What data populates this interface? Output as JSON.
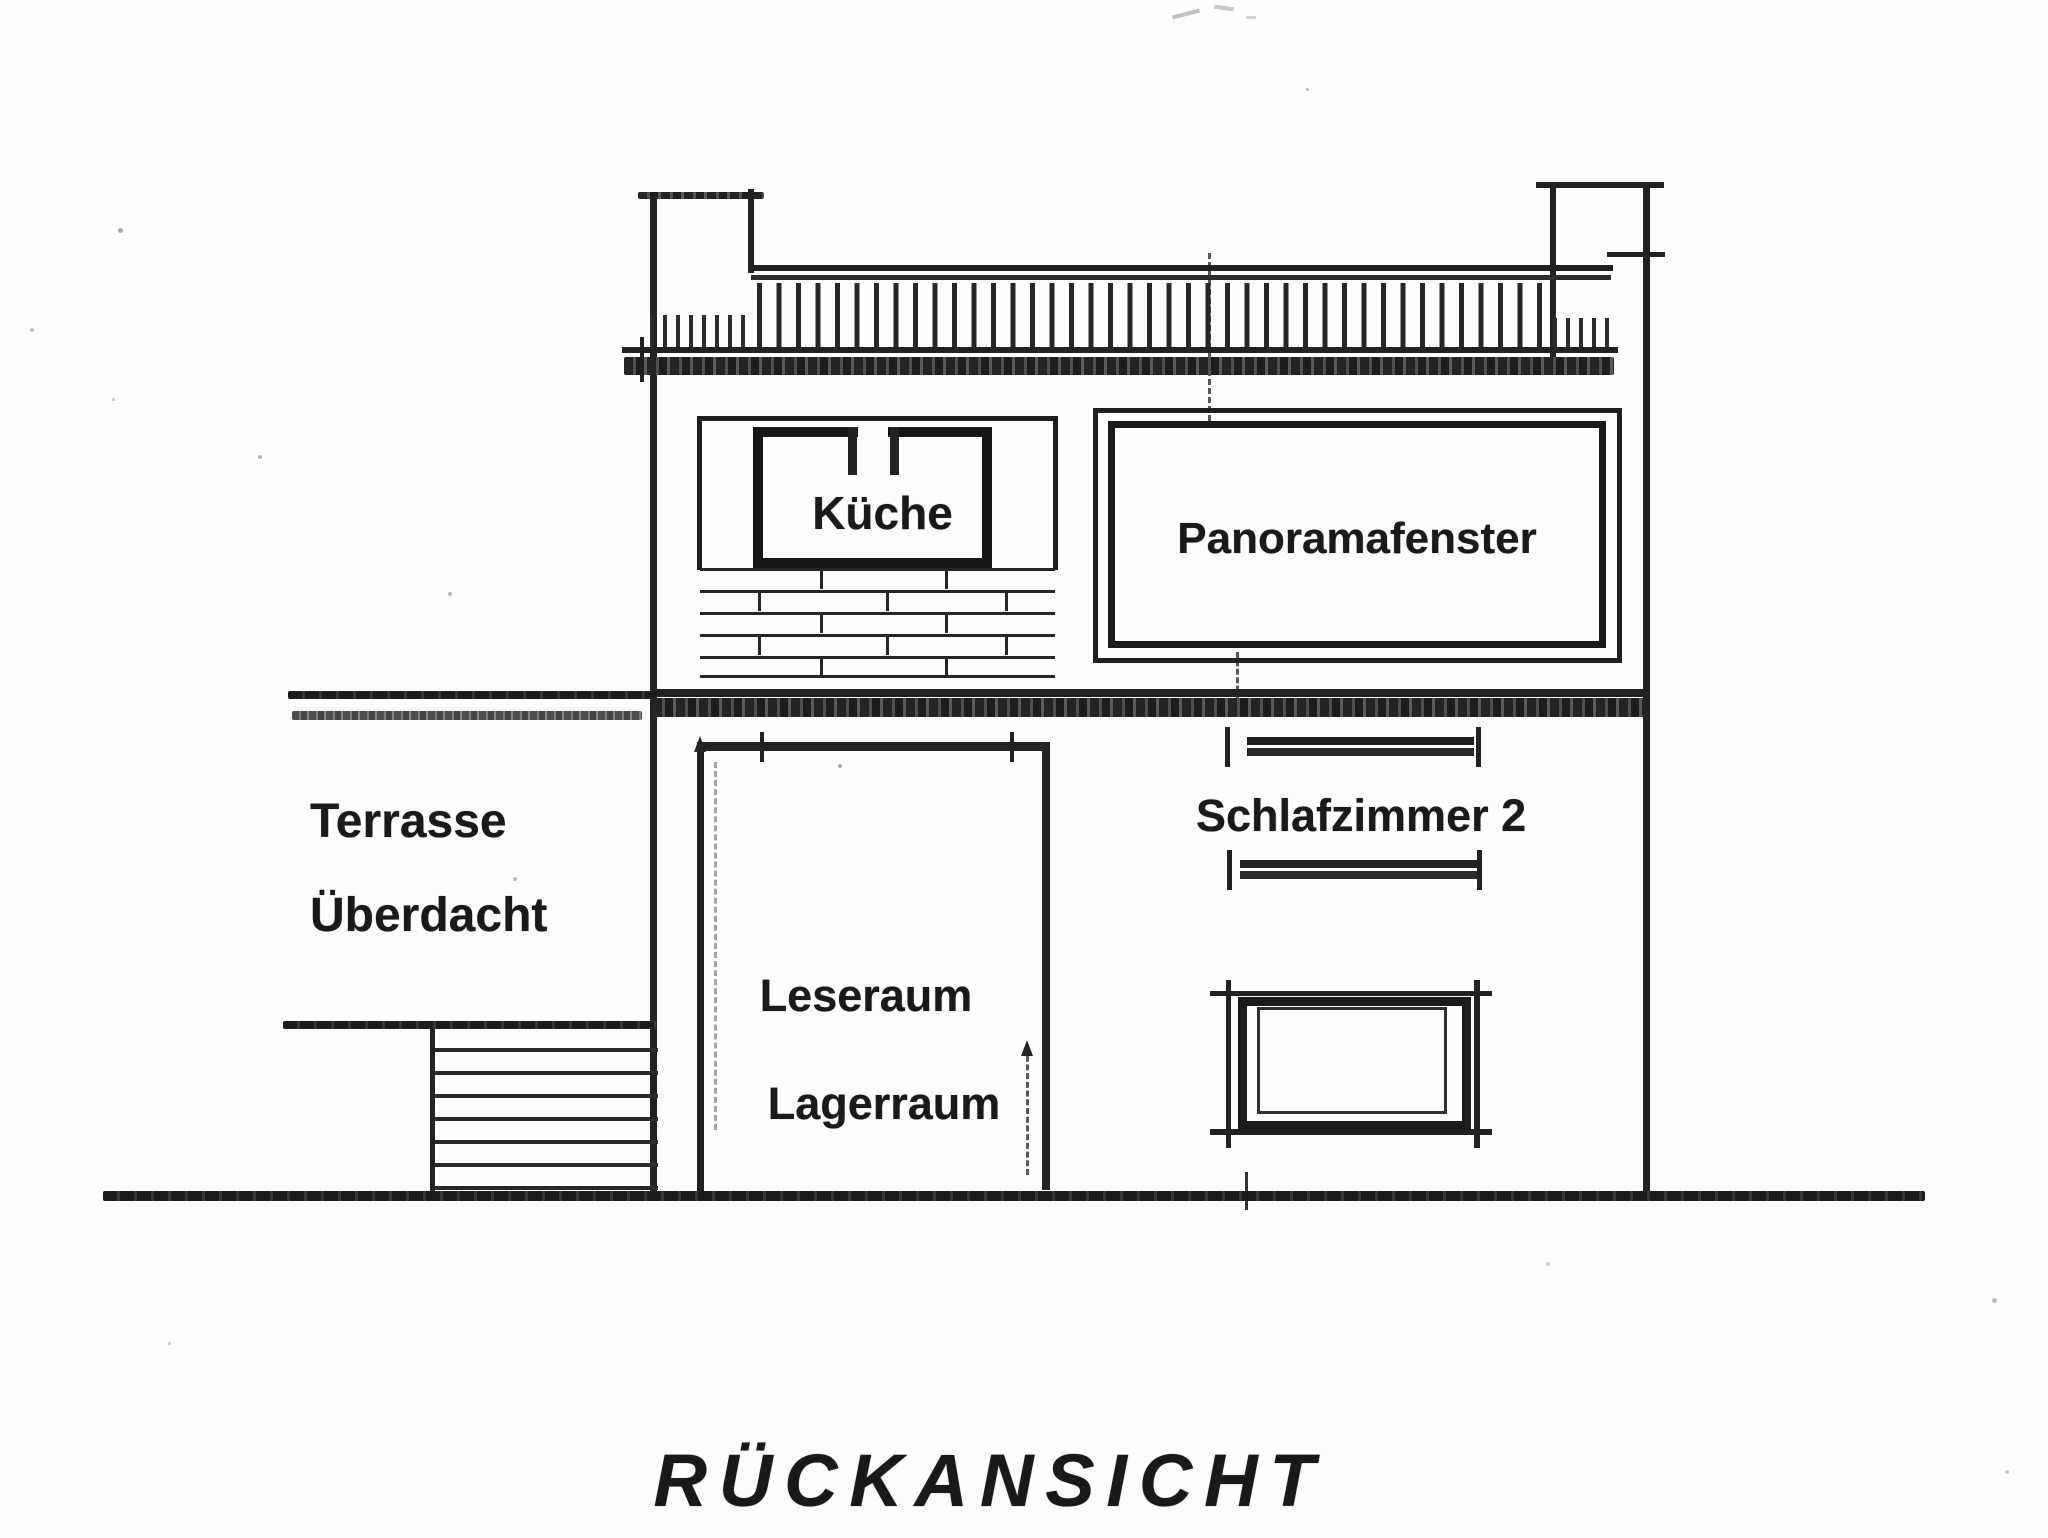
{
  "drawing": {
    "title": "RÜCKANSICHT",
    "labels": {
      "kitchen": "Küche",
      "panorama_window": "Panoramafenster",
      "terrace_line1": "Terrasse",
      "terrace_line2": "Überdacht",
      "reading_room": "Leseraum",
      "storage_room": "Lagerraum",
      "bedroom2": "Schlafzimmer 2"
    },
    "colors": {
      "ink": "#1f1f1f",
      "paper": "#fdfdfc"
    }
  }
}
